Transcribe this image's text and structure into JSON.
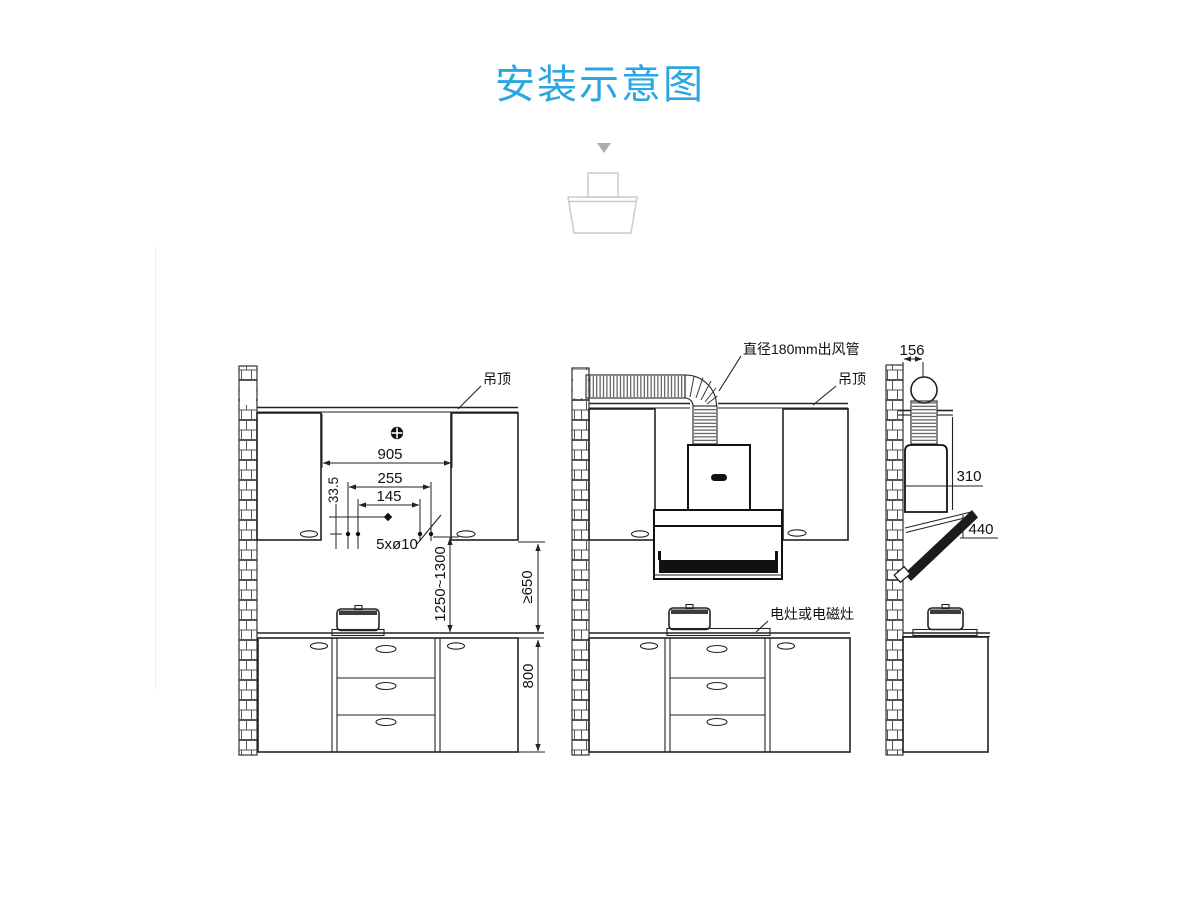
{
  "page": {
    "title": "安装示意图",
    "accent_color": "#2aa7e0"
  },
  "annotations": {
    "ceiling_left": "吊顶",
    "ceiling_middle": "吊顶",
    "duct_label": "直径180mm出风管",
    "cooker_label": "电灶或电磁灶",
    "holes_label": "5xø10"
  },
  "dimensions_front": {
    "cavity_width": "905",
    "hole_span_outer": "255",
    "hole_span_inner": "145",
    "hole_offset": "33.5",
    "mount_height": "1250~1300",
    "clearance_min": "≥650",
    "base_cabinet_height": "800"
  },
  "dimensions_side": {
    "duct_center_offset": "156",
    "top_depth": "310",
    "panel_height": "440"
  }
}
